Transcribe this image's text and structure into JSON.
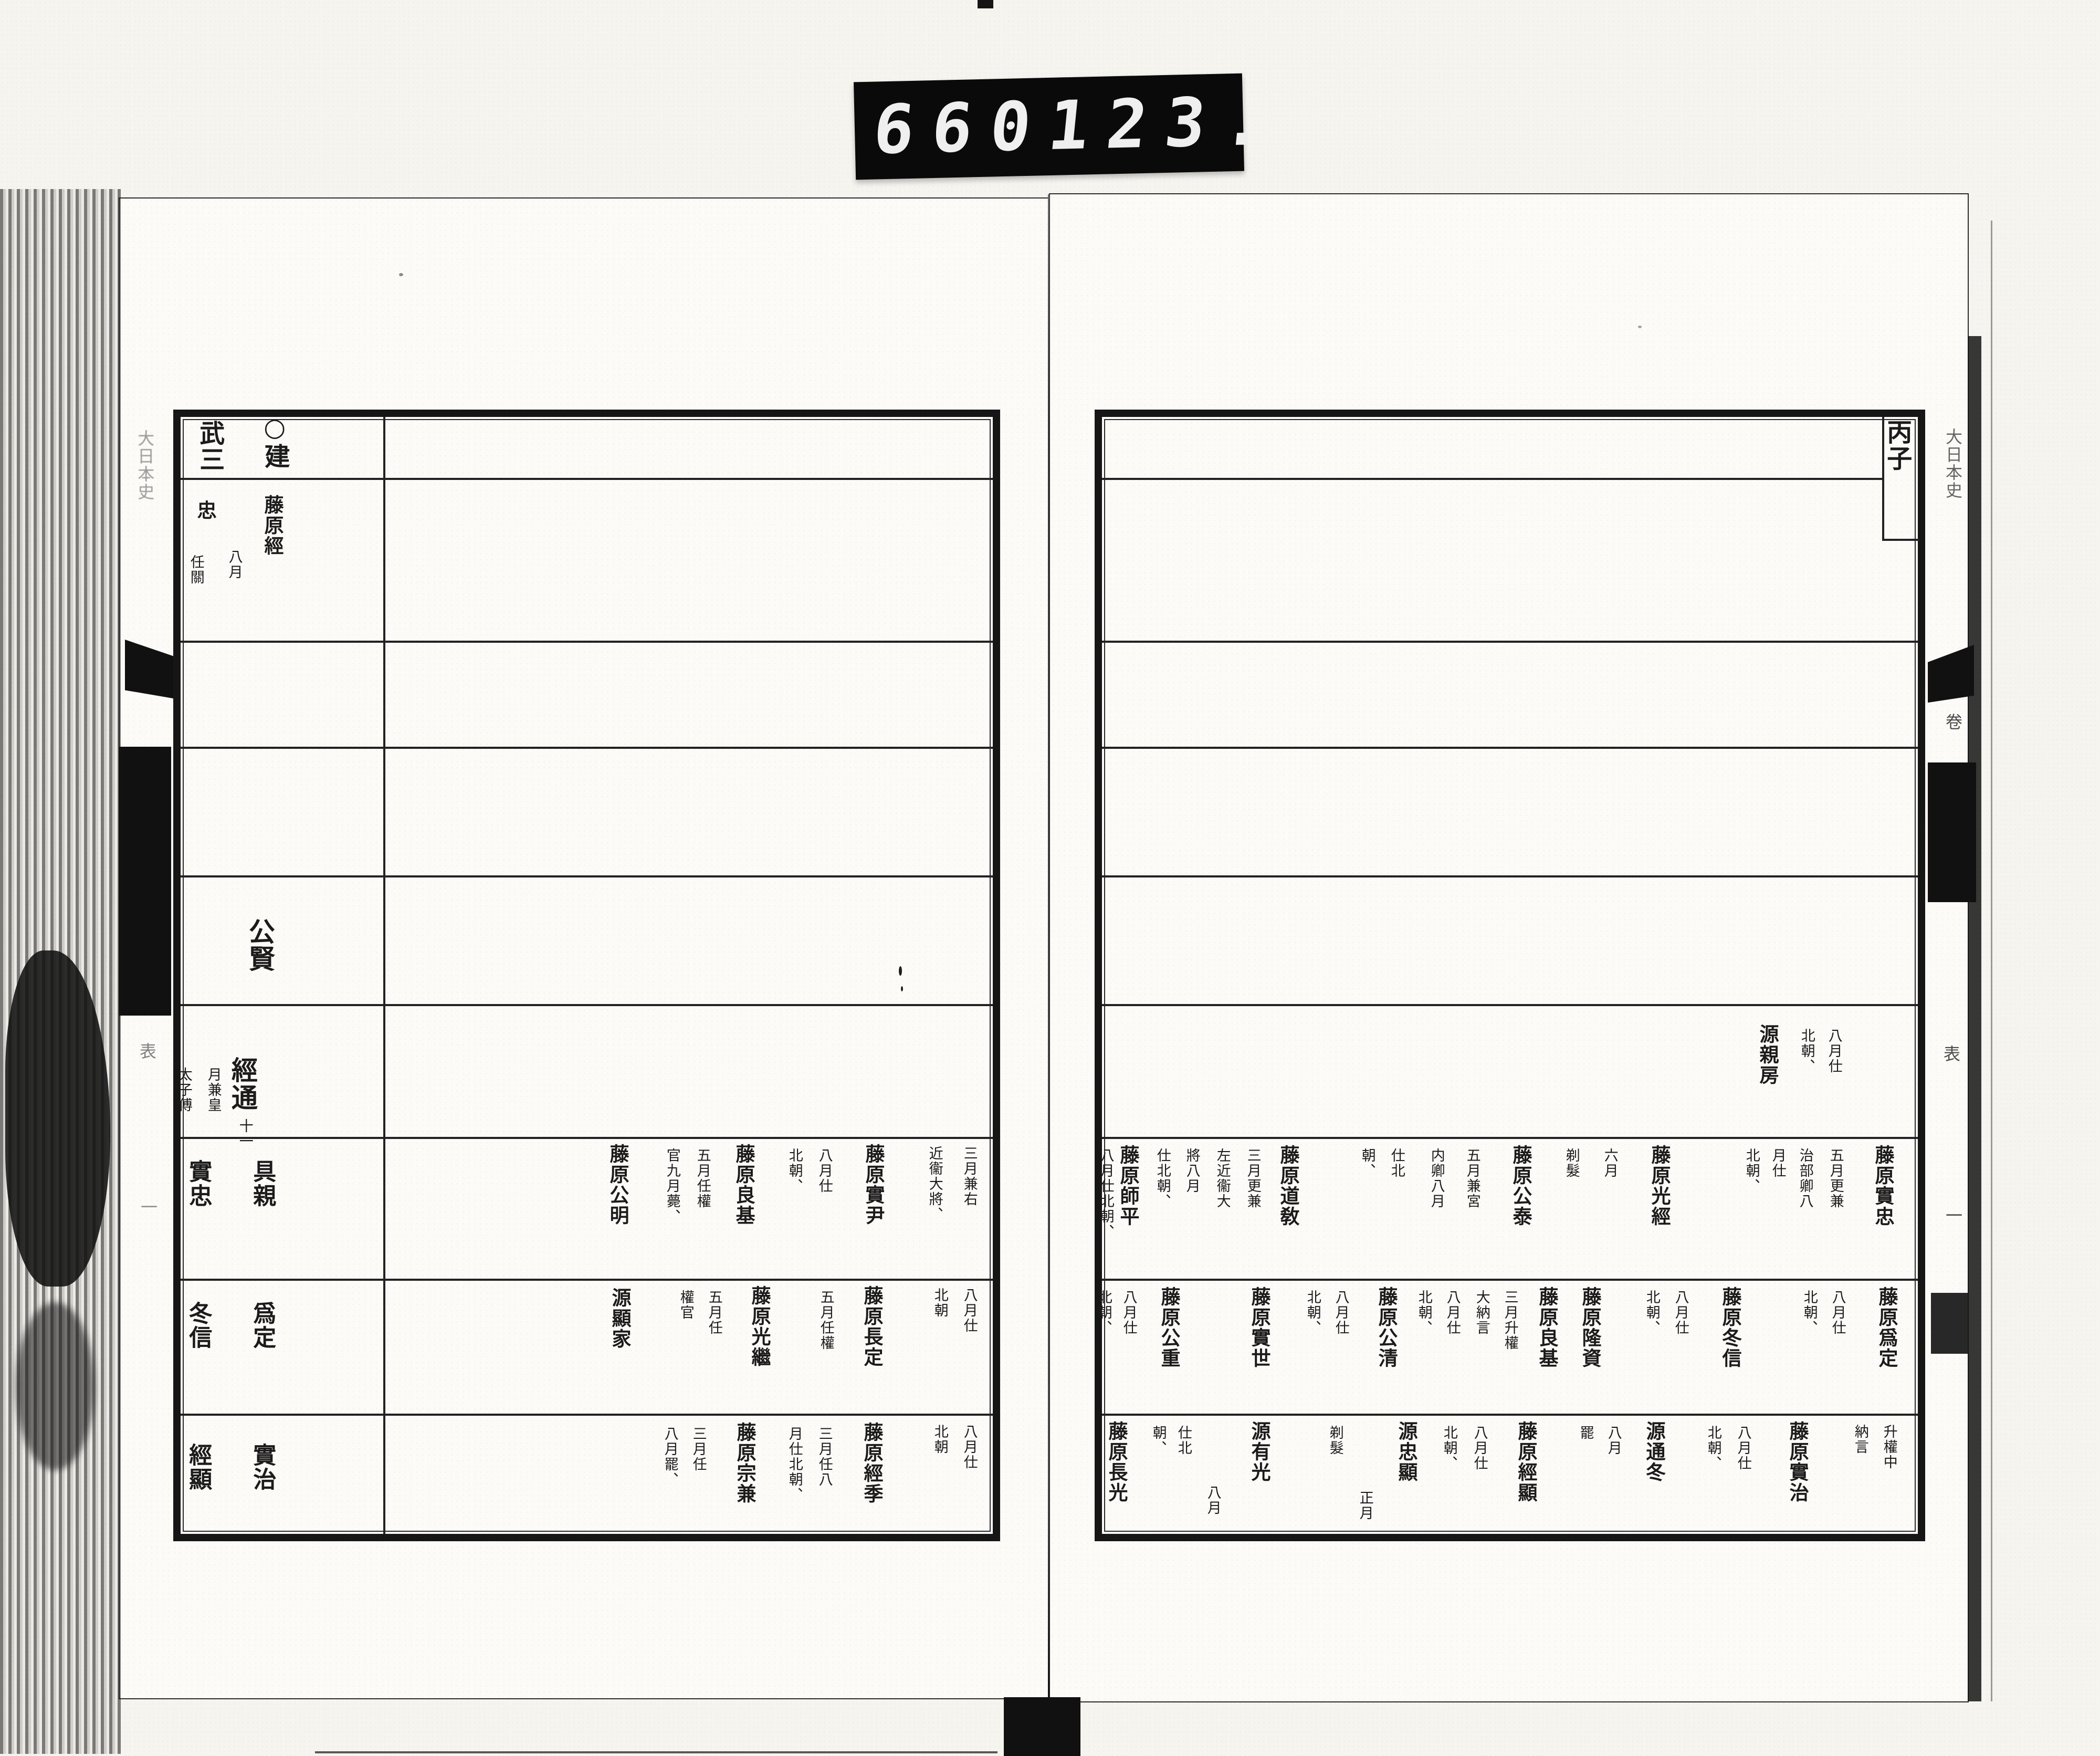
{
  "counter": {
    "frame_left": "660",
    "frame_right": "123."
  },
  "right_page": {
    "year_label": "丙子",
    "margin": {
      "title": "大日本史",
      "volume": "卷",
      "table_mark": "表",
      "number": "一"
    },
    "columns": [
      [
        "丙子",
        3612,
        798,
        "y"
      ],
      [
        "八月仕",
        3495,
        1958,
        "s"
      ],
      [
        "北朝、",
        3443,
        1958,
        "s"
      ],
      [
        "源親房",
        3368,
        1950,
        "n"
      ],
      [
        "藤原實忠",
        3588,
        2180,
        "n"
      ],
      [
        "五月更兼",
        3498,
        2186,
        "s"
      ],
      [
        "治部卿八",
        3440,
        2186,
        "s"
      ],
      [
        "月仕",
        3388,
        2186,
        "s"
      ],
      [
        "北朝、",
        3338,
        2186,
        "s"
      ],
      [
        "藤原光經",
        3162,
        2180,
        "n"
      ],
      [
        "六月",
        3068,
        2186,
        "s"
      ],
      [
        "剃髮",
        2995,
        2186,
        "s"
      ],
      [
        "藤原公泰",
        2898,
        2180,
        "n"
      ],
      [
        "五月兼宮",
        2806,
        2186,
        "s"
      ],
      [
        "内卿八月",
        2738,
        2186,
        "s"
      ],
      [
        "仕北",
        2662,
        2186,
        "s"
      ],
      [
        "朝、",
        2606,
        2186,
        "s"
      ],
      [
        "藤原道敎",
        2455,
        2180,
        "n"
      ],
      [
        "三月更兼",
        2388,
        2186,
        "s"
      ],
      [
        "左近衞大",
        2330,
        2186,
        "s"
      ],
      [
        "將八月",
        2272,
        2186,
        "s"
      ],
      [
        "仕北朝、",
        2216,
        2186,
        "s"
      ],
      [
        "藤原師平",
        2150,
        2180,
        "n"
      ],
      [
        "八月仕北朝、",
        2108,
        2186,
        "s"
      ],
      [
        "藤原爲定",
        3595,
        2450,
        "n"
      ],
      [
        "八月仕",
        3502,
        2456,
        "s"
      ],
      [
        "北朝、",
        3448,
        2456,
        "s"
      ],
      [
        "藤原冬信",
        3297,
        2450,
        "n"
      ],
      [
        "八月仕",
        3203,
        2456,
        "s"
      ],
      [
        "北朝、",
        3148,
        2456,
        "s"
      ],
      [
        "藤原隆資",
        3030,
        2450,
        "n"
      ],
      [
        "藤原良基",
        2948,
        2450,
        "n"
      ],
      [
        "三月升權",
        2878,
        2456,
        "s"
      ],
      [
        "大納言",
        2824,
        2456,
        "s"
      ],
      [
        "八月仕",
        2768,
        2456,
        "s"
      ],
      [
        "北朝、",
        2714,
        2456,
        "s"
      ],
      [
        "藤原公清",
        2642,
        2450,
        "n"
      ],
      [
        "八月仕",
        2556,
        2456,
        "s"
      ],
      [
        "北朝、",
        2502,
        2456,
        "s"
      ],
      [
        "藤原實世",
        2400,
        2450,
        "n"
      ],
      [
        "藤原公重",
        2228,
        2450,
        "n"
      ],
      [
        "八月仕",
        2152,
        2456,
        "s"
      ],
      [
        "北朝、",
        2104,
        2456,
        "s"
      ],
      [
        "升權中",
        3600,
        2712,
        "s"
      ],
      [
        "納言",
        3545,
        2712,
        "s"
      ],
      [
        "藤原實治",
        3425,
        2706,
        "n"
      ],
      [
        "八月仕",
        3322,
        2714,
        "s"
      ],
      [
        "北朝、",
        3265,
        2714,
        "s"
      ],
      [
        "源通冬",
        3152,
        2706,
        "n"
      ],
      [
        "八月",
        3075,
        2714,
        "s"
      ],
      [
        "罷",
        3022,
        2714,
        "s"
      ],
      [
        "藤原經顯",
        2908,
        2706,
        "n"
      ],
      [
        "八月仕",
        2820,
        2714,
        "s"
      ],
      [
        "北朝、",
        2762,
        2714,
        "s"
      ],
      [
        "源忠顯",
        2680,
        2706,
        "n"
      ],
      [
        "正月",
        2602,
        2838,
        "s"
      ],
      [
        "剃髮",
        2545,
        2714,
        "s"
      ],
      [
        "源有光",
        2400,
        2706,
        "n"
      ],
      [
        "八月",
        2312,
        2828,
        "s"
      ],
      [
        "仕北",
        2256,
        2714,
        "s"
      ],
      [
        "朝、",
        2208,
        2714,
        "s"
      ],
      [
        "藤原長光",
        2128,
        2706,
        "n"
      ]
    ]
  },
  "left_page": {
    "year_label": "○建武三",
    "margin": {
      "title": "大日本史",
      "table_mark": "表",
      "number": "一"
    },
    "columns": [
      [
        "○建",
        522,
        786,
        "y"
      ],
      [
        "武三",
        398,
        800,
        "y"
      ],
      [
        "藤原經",
        520,
        942,
        "n"
      ],
      [
        "忠",
        392,
        952,
        "n"
      ],
      [
        "八月",
        448,
        1046,
        "s"
      ],
      [
        "任關",
        375,
        1056,
        "s"
      ],
      [
        "公賢",
        495,
        1748,
        "b"
      ],
      [
        "經通",
        462,
        2012,
        "b"
      ],
      [
        "十一",
        468,
        2130,
        "s"
      ],
      [
        "月兼皇",
        408,
        2032,
        "s"
      ],
      [
        "太子傅",
        352,
        2032,
        "s"
      ],
      [
        "三月兼右",
        1848,
        2182,
        "s"
      ],
      [
        "近衞大將、",
        1782,
        2182,
        "s"
      ],
      [
        "藤原實尹",
        1665,
        2178,
        "n"
      ],
      [
        "八月仕",
        1572,
        2186,
        "s"
      ],
      [
        "北朝、",
        1515,
        2186,
        "s"
      ],
      [
        "藤原良基",
        1418,
        2178,
        "n"
      ],
      [
        "五月任權",
        1340,
        2186,
        "s"
      ],
      [
        "官九月薨、",
        1282,
        2186,
        "s"
      ],
      [
        "藤原公明",
        1178,
        2178,
        "n"
      ],
      [
        "具親",
        500,
        2208,
        "g"
      ],
      [
        "實忠",
        378,
        2208,
        "g"
      ],
      [
        "八月仕",
        1848,
        2452,
        "s"
      ],
      [
        "北朝",
        1792,
        2452,
        "s"
      ],
      [
        "藤原長定",
        1662,
        2448,
        "n"
      ],
      [
        "五月任權",
        1575,
        2456,
        "s"
      ],
      [
        "藤原光繼",
        1448,
        2448,
        "n"
      ],
      [
        "五月任",
        1362,
        2456,
        "s"
      ],
      [
        "權官",
        1308,
        2456,
        "s"
      ],
      [
        "源顯家",
        1182,
        2452,
        "n"
      ],
      [
        "爲定",
        500,
        2478,
        "g"
      ],
      [
        "冬信",
        378,
        2478,
        "g"
      ],
      [
        "八月仕",
        1848,
        2712,
        "s"
      ],
      [
        "北朝",
        1792,
        2712,
        "s"
      ],
      [
        "藤原經季",
        1662,
        2708,
        "n"
      ],
      [
        "三月任八",
        1572,
        2716,
        "s"
      ],
      [
        "月仕北朝、",
        1515,
        2716,
        "s"
      ],
      [
        "藤原宗兼",
        1420,
        2708,
        "n"
      ],
      [
        "三月任",
        1332,
        2716,
        "s"
      ],
      [
        "八月罷、",
        1278,
        2716,
        "s"
      ],
      [
        "實治",
        500,
        2748,
        "g"
      ],
      [
        "經顯",
        378,
        2748,
        "g"
      ]
    ]
  }
}
